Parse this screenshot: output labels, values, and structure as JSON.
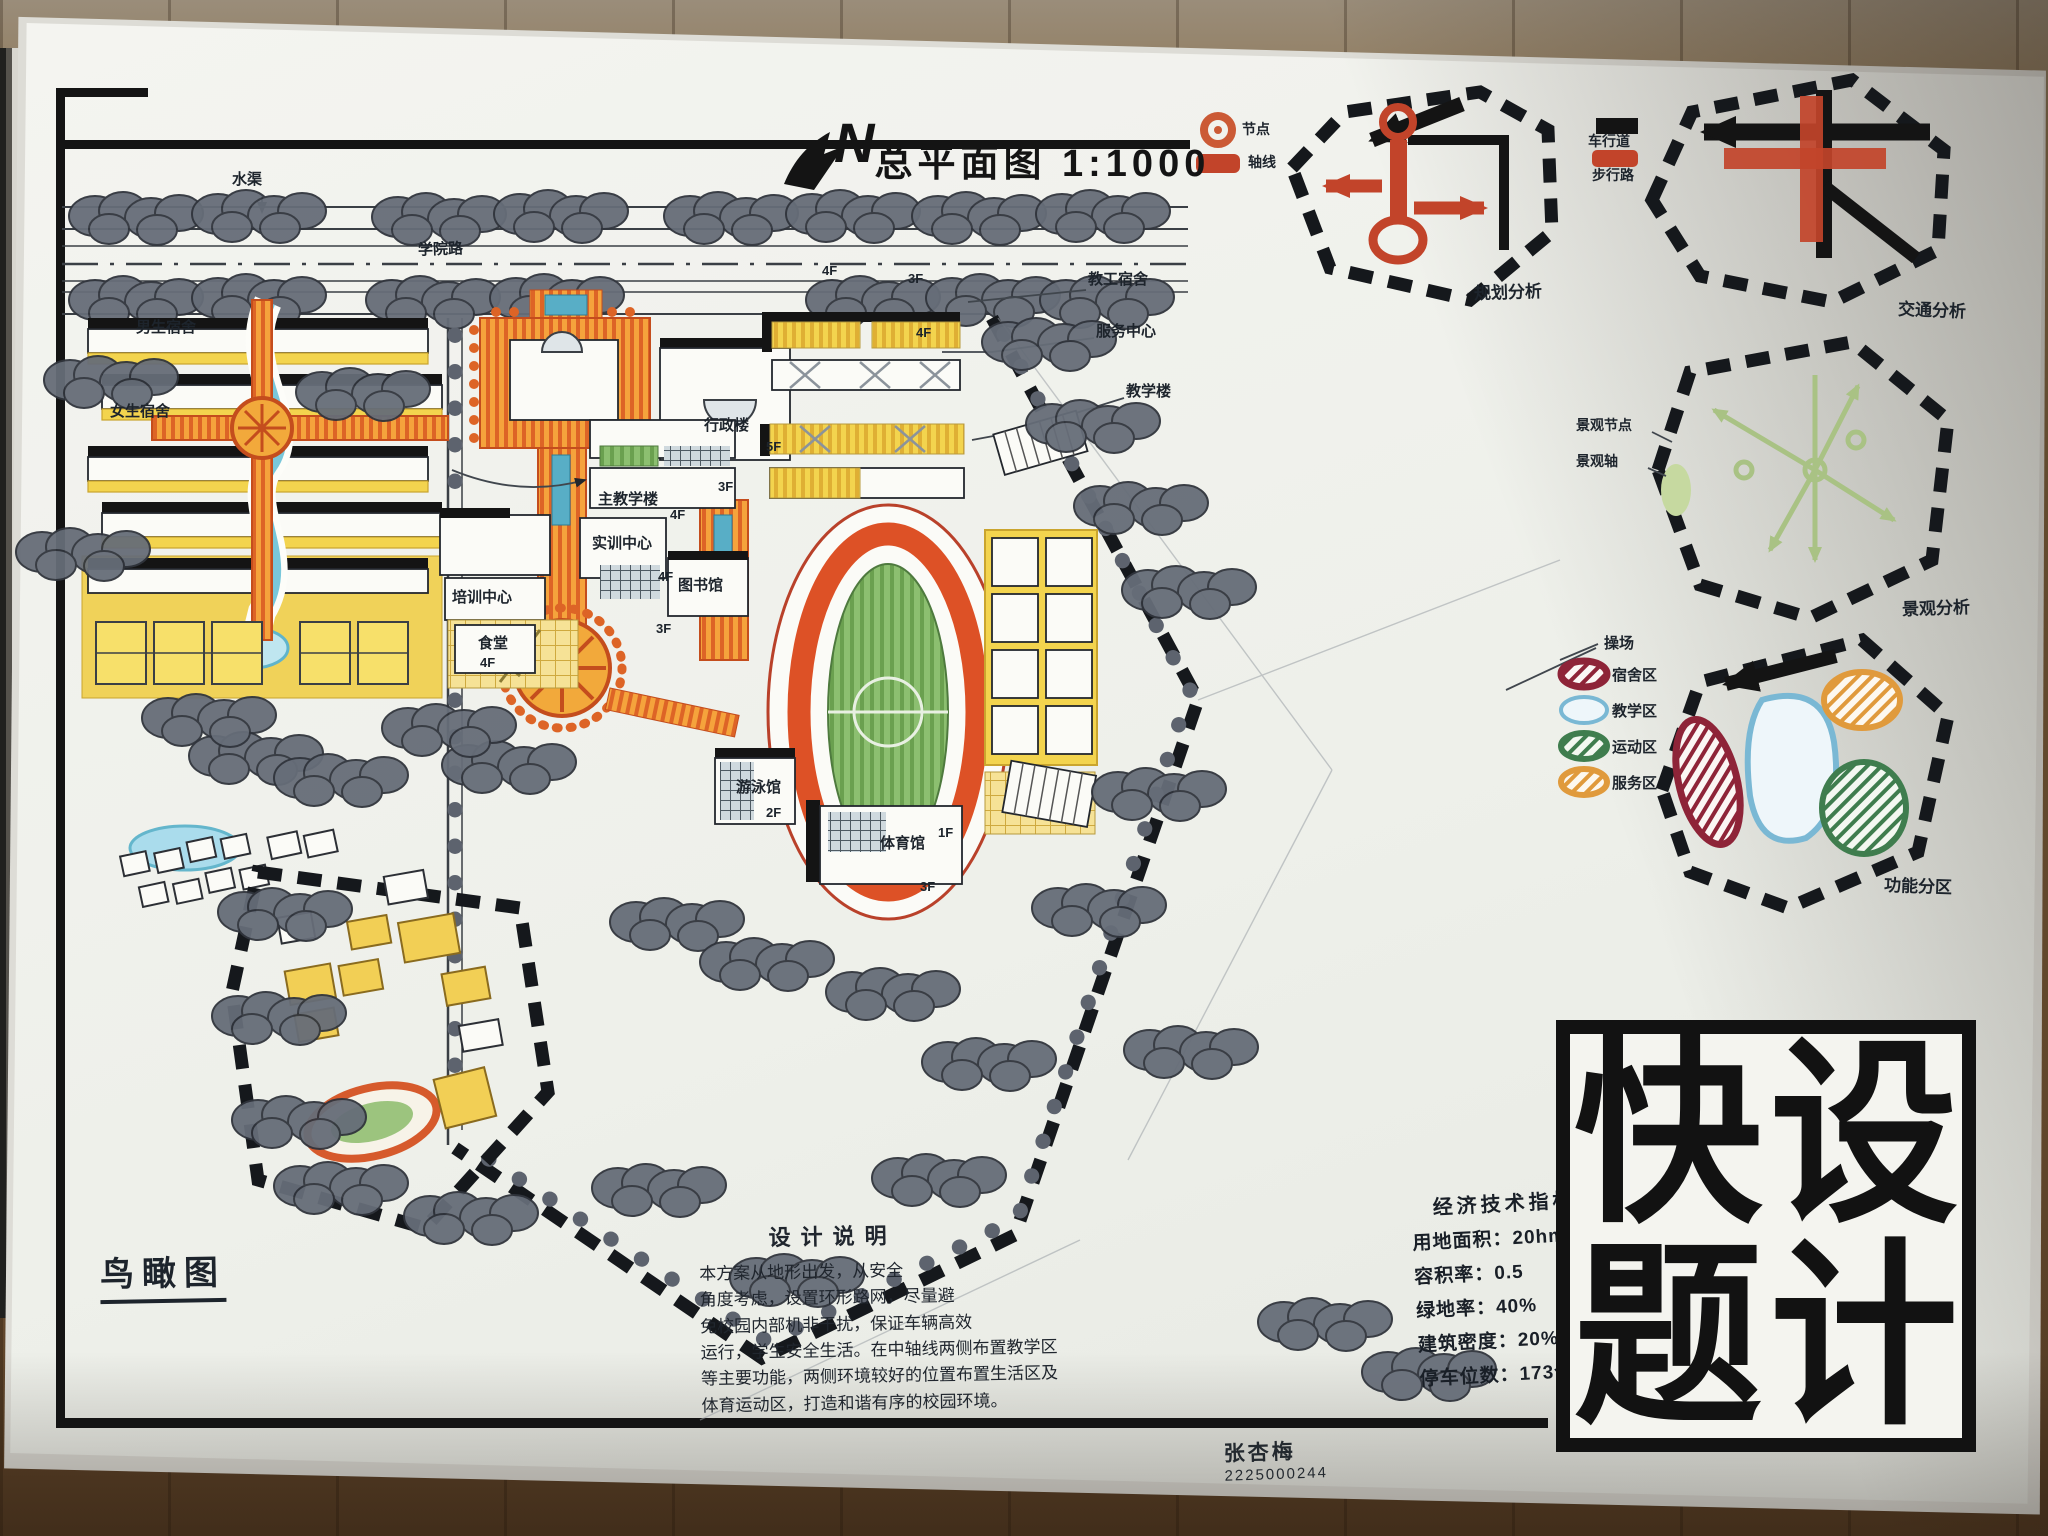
{
  "title": {
    "north_letter": "N",
    "text": "总平面图 1:1000"
  },
  "legend_node": "节点",
  "legend_axis": "轴线",
  "legend_vehicle": "车行道",
  "legend_ped": "步行路",
  "analysis_titles": {
    "planning": "规划分析",
    "traffic": "交通分析",
    "landscape": "景观分析",
    "zoning": "功能分区"
  },
  "landscape_labels": {
    "node": "景观节点",
    "axis": "景观轴"
  },
  "zones": [
    {
      "label": "宿舍区",
      "color": "#8e2438"
    },
    {
      "label": "教学区",
      "color": "#7ab8d4"
    },
    {
      "label": "运动区",
      "color": "#3f7d4e"
    },
    {
      "label": "服务区",
      "color": "#e09a3c"
    }
  ],
  "plan_labels": {
    "shuiqu": "水渠",
    "xueyuanlu": "学院路",
    "nanshe": "男生宿舍",
    "nvshe": "女生宿舍",
    "xingzheng": "行政楼",
    "shixun": "实训中心",
    "peixun": "培训中心",
    "zhujiao": "主教学楼",
    "tushuguan": "图书馆",
    "shitang": "食堂",
    "jiaogong": "教工宿舍",
    "fuwu": "服务中心",
    "jiaoxuelou": "教学楼",
    "youyong": "游泳馆",
    "tiyuguan": "体育馆",
    "caochang": "操场"
  },
  "floors": {
    "f1": "1F",
    "f2": "2F",
    "f3": "3F",
    "f4": "4F",
    "f5": "5F"
  },
  "birdseye_label": "鸟瞰图",
  "design_notes": {
    "title": "设计说明",
    "body": "本方案从地形出发，从安全\n角度考虑，设置环形路网，尽量避\n免校园内部机非干扰，保证车辆高效\n运行，学生安全生活。在中轴线两侧布置教学区\n等主要功能，两侧环境较好的位置布置生活区及\n体育运动区，打造和谐有序的校园环境。"
  },
  "indicators": {
    "title": "经济技术指标",
    "items": [
      {
        "label": "用地面积：",
        "value": "20hm²"
      },
      {
        "label": "容积率：",
        "value": "0.5"
      },
      {
        "label": "绿地率：",
        "value": "40%"
      },
      {
        "label": "建筑密度：",
        "value": "20%"
      },
      {
        "label": "停车位数：",
        "value": "173个"
      }
    ]
  },
  "logotype": {
    "reading": "快题设计",
    "chars": [
      "快",
      "设",
      "题",
      "计"
    ]
  },
  "signature": {
    "name": "张杏梅",
    "id": "2225000244"
  },
  "colors": {
    "ink": "#141414",
    "yellow": "#f3d44e",
    "orange": "#f5a33c",
    "red_orange": "#c2442a",
    "track": "#dd5126",
    "field_green": "#84b769",
    "tree_grey": "#666d78",
    "stream_blue": "#79c7da",
    "analysis_green": "#a9c284"
  }
}
